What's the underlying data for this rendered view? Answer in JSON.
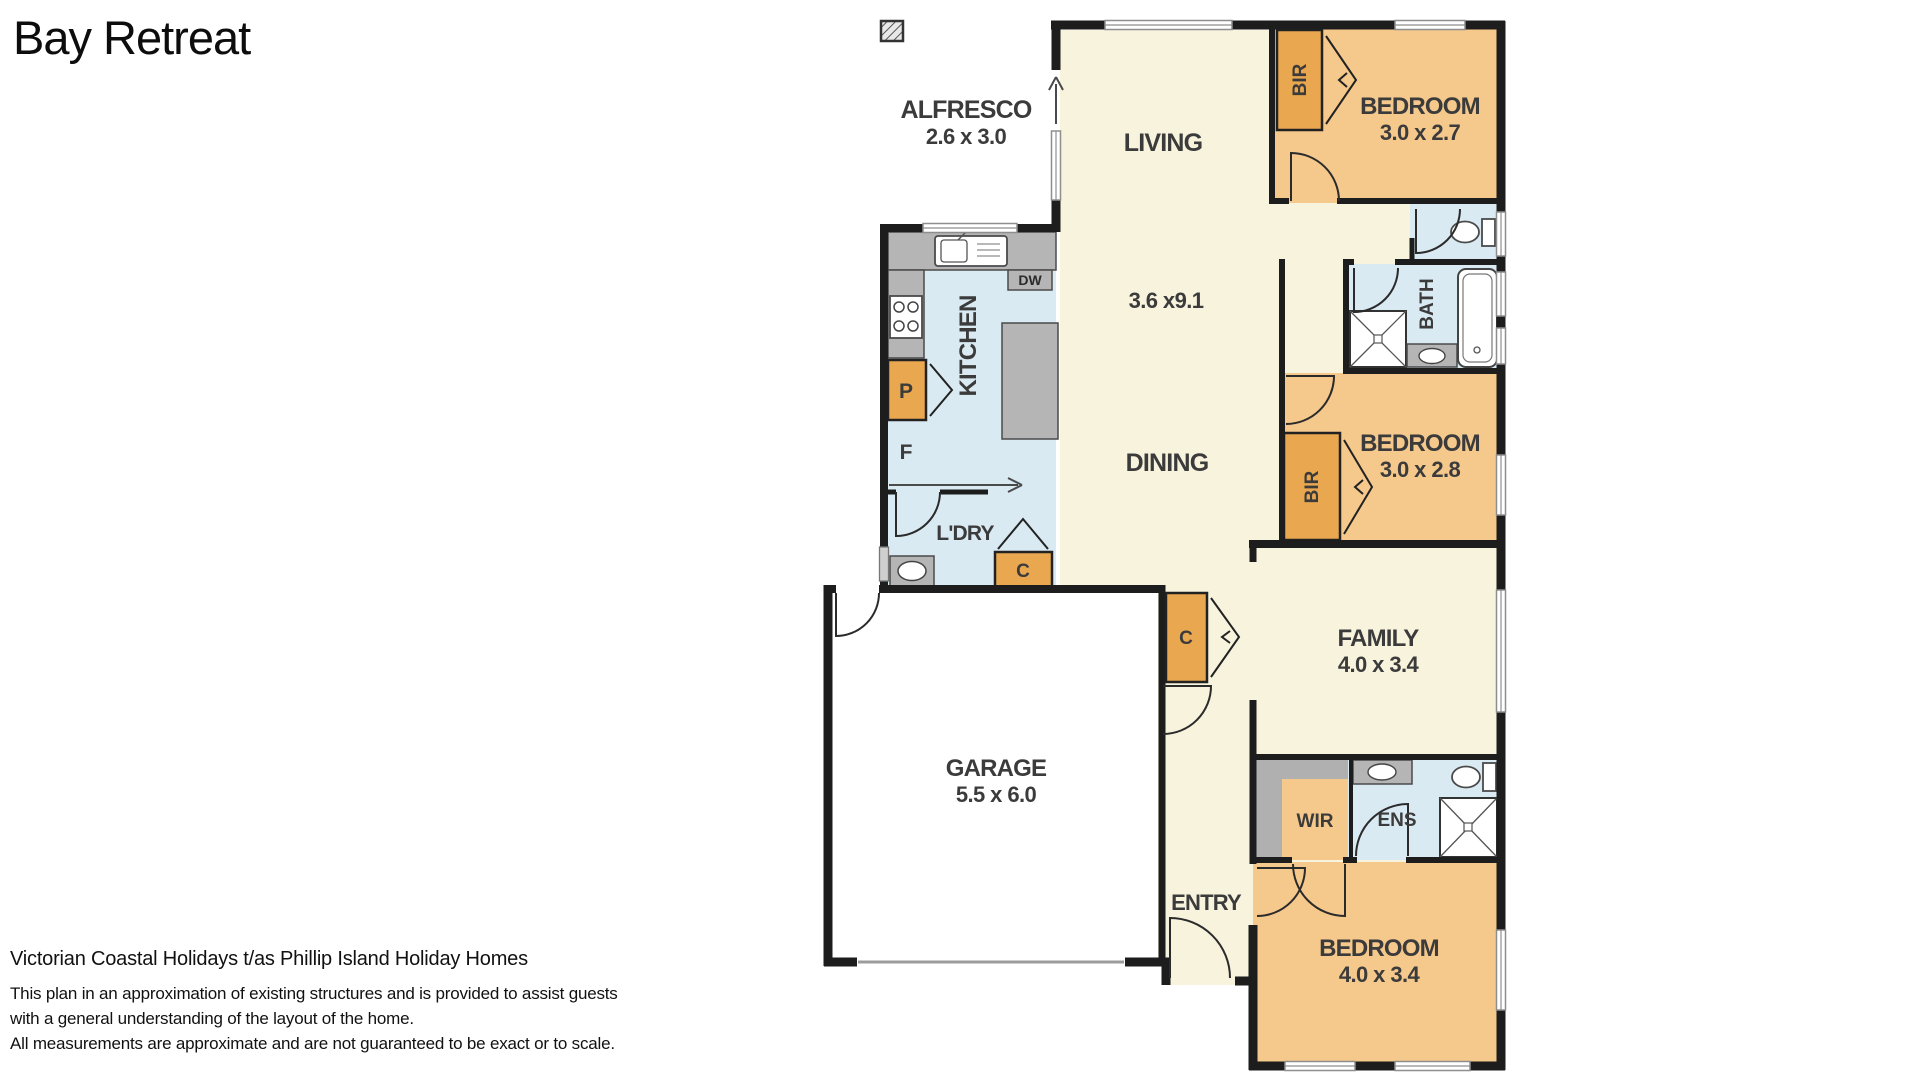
{
  "title": "Bay Retreat",
  "colors": {
    "room_cream": "#f8f3dd",
    "room_orange": "#f5c88c",
    "robe_orange": "#e9a74f",
    "wet_blue": "#d9eaf3",
    "counter_grey": "#b5b5b5",
    "band_grey": "#b0b0b0",
    "garage_white": "#ffffff",
    "wall_black": "#1d1d1d",
    "label_grey": "#3b3b3b"
  },
  "plan": {
    "rooms": [
      {
        "id": "alfresco",
        "label": "ALFRESCO",
        "dims": "2.6 x 3.0"
      },
      {
        "id": "living",
        "label": "LIVING",
        "dims": "3.6 x9.1"
      },
      {
        "id": "dining",
        "label": "DINING",
        "dims": ""
      },
      {
        "id": "kitchen",
        "label": "KITCHEN",
        "dims": ""
      },
      {
        "id": "bedroom1",
        "label": "BEDROOM",
        "dims": "3.0 x 2.7"
      },
      {
        "id": "bath",
        "label": "BATH",
        "dims": ""
      },
      {
        "id": "bedroom2",
        "label": "BEDROOM",
        "dims": "3.0 x 2.8"
      },
      {
        "id": "laundry",
        "label": "L'DRY",
        "dims": ""
      },
      {
        "id": "family",
        "label": "FAMILY",
        "dims": "4.0 x 3.4"
      },
      {
        "id": "garage",
        "label": "GARAGE",
        "dims": "5.5 x 6.0"
      },
      {
        "id": "wir",
        "label": "WIR",
        "dims": ""
      },
      {
        "id": "ens",
        "label": "ENS",
        "dims": ""
      },
      {
        "id": "entry",
        "label": "ENTRY",
        "dims": ""
      },
      {
        "id": "bedroom3",
        "label": "BEDROOM",
        "dims": "4.0 x 3.4"
      }
    ],
    "fixtures": {
      "dishwasher": "DW",
      "pantry": "P",
      "fridge": "F",
      "cupboard": "C",
      "robe": "BIR"
    }
  },
  "footer": {
    "company": "Victorian Coastal Holidays t/as Phillip Island Holiday Homes",
    "line1": "This plan in an approximation of existing structures and is provided to assist guests",
    "line2": "with a general understanding of the layout of the home.",
    "line3": "All measurements are approximate and are not guaranteed to be exact or to scale."
  }
}
